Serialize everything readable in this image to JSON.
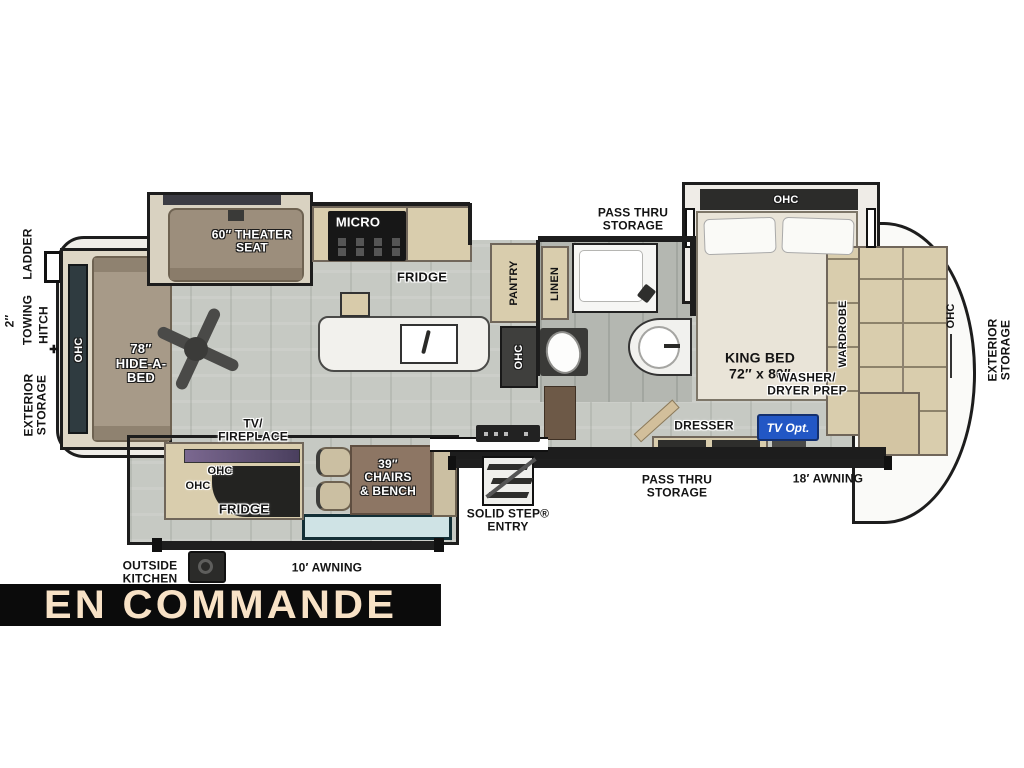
{
  "colors": {
    "tv_opt_bg": "#2257c5",
    "banner_bg": "#0b0b0b",
    "banner_text": "#f8e2c6",
    "wall": "#1d1d1d",
    "cabinet": "#d9cdad"
  },
  "banner": {
    "status_text": "EN COMMANDE"
  },
  "exterior": {
    "ladder": "LADDER",
    "hitch_size": "2″",
    "towing": "TOWING",
    "hitch": "HITCH",
    "hitch_marker": "✚",
    "rear_storage": "EXTERIOR\nSTORAGE",
    "front_storage": "EXTERIOR\nSTORAGE",
    "pass_thru_top": "PASS THRU\nSTORAGE",
    "pass_thru_bottom": "PASS THRU\nSTORAGE",
    "awning_small": "10′ AWNING",
    "awning_large": "18′ AWNING",
    "outside_kitchen": "OUTSIDE\nKITCHEN",
    "entry": "SOLID STEP®\nENTRY"
  },
  "living": {
    "sofa_ohc": "OHC",
    "hide_a_bed": "78″\nHIDE-A-\nBED",
    "theater_seat": "60″ THEATER\nSEAT",
    "tv_fireplace": "TV/\nFIREPLACE",
    "ent_ohc_1": "OHC",
    "ent_ohc_2": "OHC",
    "outside_fridge": "FRIDGE",
    "chairs_bench": "39″\nCHAIRS\n& BENCH"
  },
  "kitchen": {
    "micro": "MICRO",
    "fridge": "FRIDGE",
    "pantry": "PANTRY",
    "hall_ohc": "OHC"
  },
  "bath": {
    "linen": "LINEN"
  },
  "bedroom": {
    "ohc": "OHC",
    "king_bed": "KING BED\n72″ x 80″",
    "wardrobe": "WARDROBE",
    "front_ohc": "OHC",
    "washer_dryer": "WASHER/\nDRYER PREP",
    "dresser": "DRESSER",
    "tv_opt": "TV Opt."
  }
}
